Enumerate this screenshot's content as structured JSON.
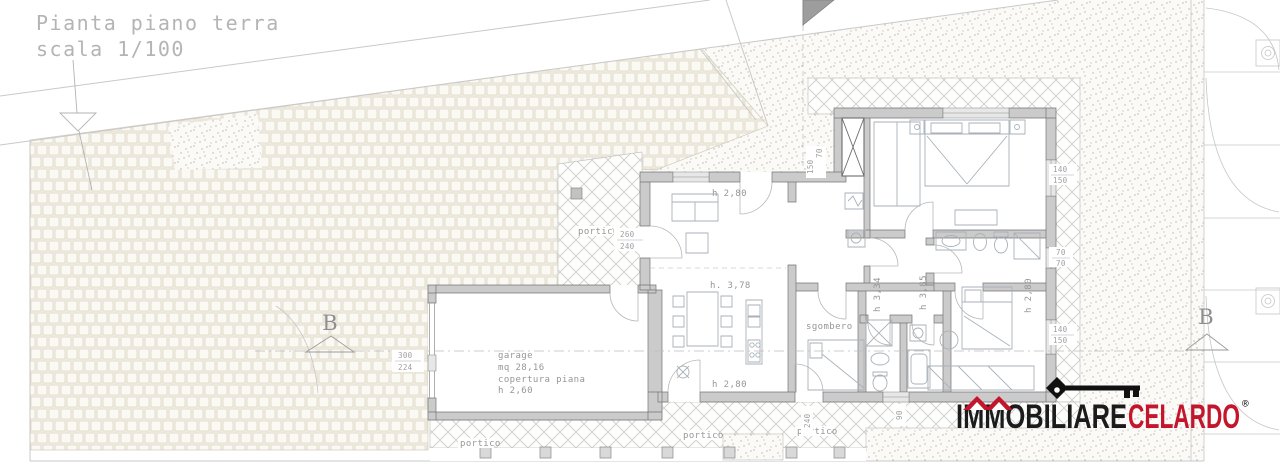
{
  "title": {
    "line1": "Pianta piano terra",
    "line2": "scala 1/100"
  },
  "rooms": {
    "garage_name": "garage",
    "garage_area": "mq 28,16",
    "garage_note": "copertura piana",
    "garage_height": "h 2,60",
    "sgombero": "sgombero",
    "portico": "portico"
  },
  "heights": {
    "living": "h 2,80",
    "dining": "h. 3,78",
    "kitchen": "h 2,80",
    "bath": "h 3,34",
    "hall": "h 3,85",
    "bedroom": "h 2,80"
  },
  "dimensions": {
    "portico_door": [
      "260",
      "240"
    ],
    "garage_front": [
      "300",
      "224"
    ],
    "window_top": [
      "140",
      "150"
    ],
    "window_mid": [
      "70",
      "70"
    ],
    "window_bottom": [
      "140",
      "150"
    ],
    "entry_side": [
      "70",
      "150"
    ],
    "door_bottom": "240",
    "window_bottom_wall": "90"
  },
  "section": {
    "label": "B"
  },
  "logo": {
    "word1": "IMMOBILIARE",
    "word2": "CELARDO",
    "registered": "®",
    "black": "#1b1b1b",
    "red": "#c3162c"
  },
  "colors": {
    "wall_fill": "#cbcbcb",
    "wall_stroke": "#757575",
    "site_line": "#c6c6c6",
    "text_gray": "#969696",
    "paving_tone": "#f4f1e7"
  }
}
